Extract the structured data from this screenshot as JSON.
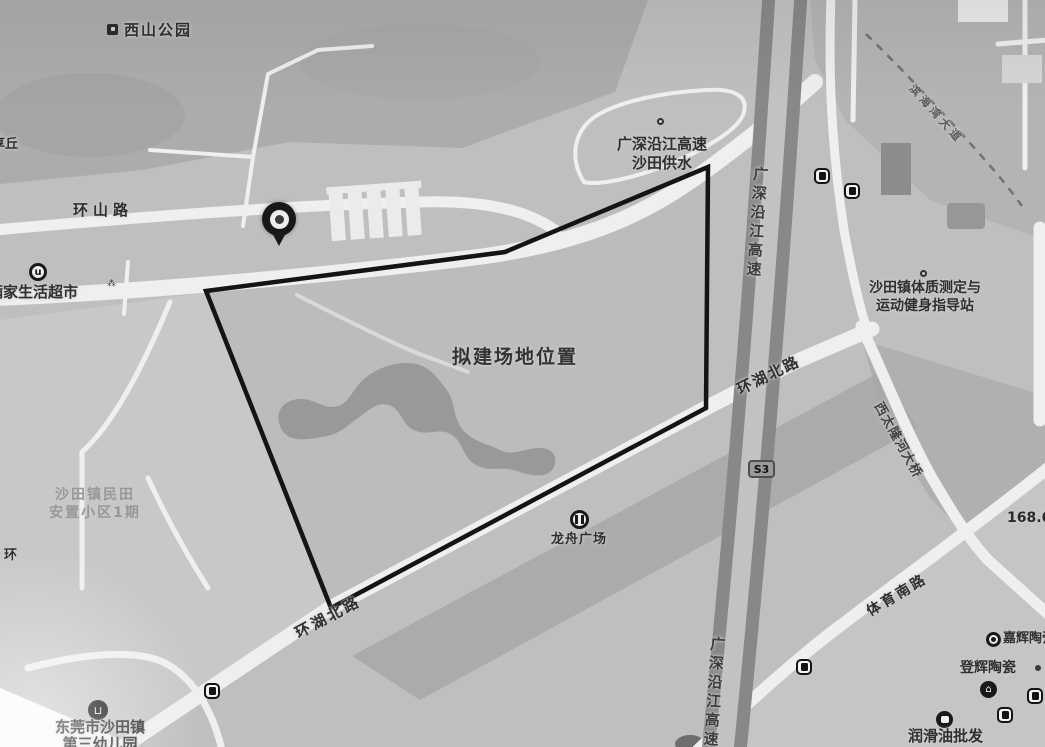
{
  "map": {
    "figure_type": "proposed-site-location-map",
    "site": {
      "label": "拟建场地位置"
    },
    "roads": {
      "huanshan": "环山路",
      "huanhu_north": "环湖北路",
      "coastal_expressway": "广深沿江高速",
      "sports_south": "体育南路",
      "binhai": "滨海湾大道",
      "bridge": "西太隆河大桥",
      "s3_badge": "S3"
    },
    "pois": {
      "park": "西山公园",
      "hamlet": "享丘",
      "supermarket": "满家生活超市",
      "water_supply_line1": "广深沿江高速",
      "water_supply_line2": "沙田供水",
      "fitness_line1": "沙田镇体质测定与",
      "fitness_line2": "运动健身指导站",
      "plaza": "龙舟广场",
      "resettlement_line1": "沙田镇民田",
      "resettlement_line2": "安置小区1期",
      "huan_partial": "环",
      "kindergarten_line1": "东莞市沙田镇",
      "kindergarten_line2": "第三幼儿园",
      "jiahui": "嘉辉陶瓷",
      "denghui": "登辉陶瓷",
      "lube_wholesale": "润滑油批发",
      "distance_marker": "168.6米",
      "tiny_mark": "⁂"
    },
    "icons": {
      "pin": "location-pin",
      "bus": "bus-stop",
      "school": "school",
      "plaza": "plaza",
      "supermarket": "supermarket",
      "shop": "shop",
      "poi_dot": "poi-dot"
    },
    "colors": {
      "paper": "#bfbfc1",
      "road": "#f0f0f1",
      "site_outline": "#141416",
      "pond": "#99999b",
      "highway": "#88888a"
    }
  }
}
